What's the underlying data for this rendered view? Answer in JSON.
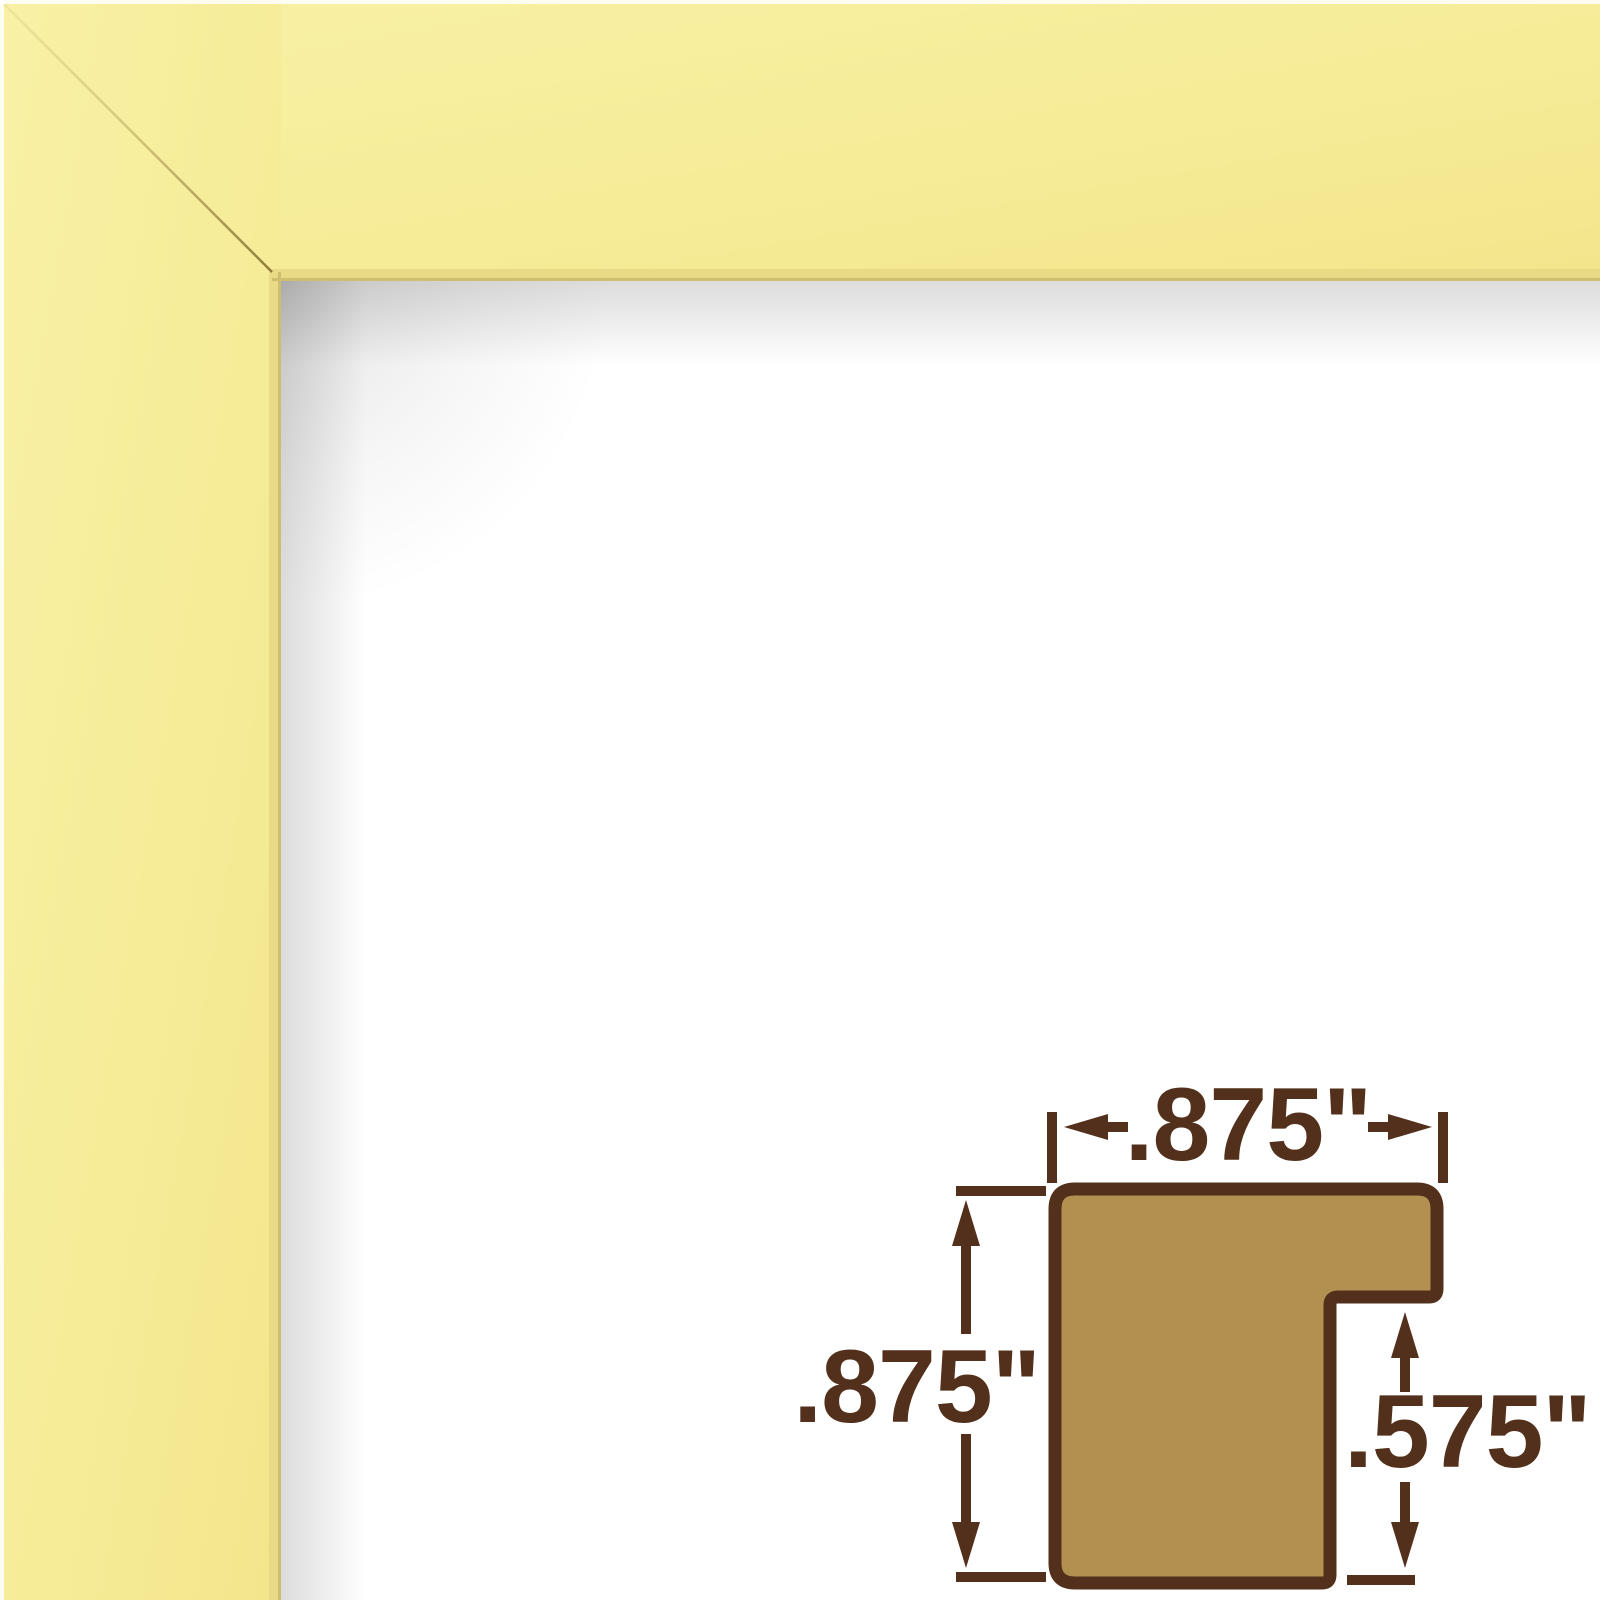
{
  "image": {
    "description": "Yellow picture-frame corner sample on white background with moulding profile cross-section diagram",
    "background_color": "#FFFFFF"
  },
  "frame_sample": {
    "finish_color": "#F6EC98",
    "finish_color_light": "#F8F0A5",
    "finish_color_deep": "#F2E68C",
    "inner_lip_color": "#E9DA85",
    "edge_line_color": "#CDBE70",
    "miter_seam_color": "#8C7A3C",
    "face_width_px": 281
  },
  "profile_diagram": {
    "fill_color": "#B29150",
    "outline_color": "#53301B",
    "labels": {
      "width": ".875\"",
      "height": ".875\"",
      "rabbet": ".575\""
    }
  }
}
